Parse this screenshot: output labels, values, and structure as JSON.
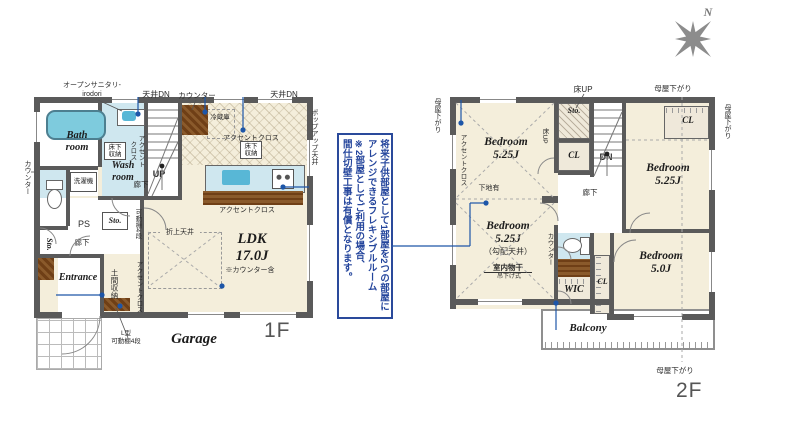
{
  "compass": {
    "label": "N"
  },
  "colors": {
    "wall": "#5a5a5a",
    "floor_cream": "#f4eedb",
    "wet_blue": "#cfe7ef",
    "tub_blue": "#7ecbdd",
    "wood_brown": "#7a4a20",
    "leader_blue": "#1d56a8",
    "note_blue": "#24459c"
  },
  "ann": {
    "lines": [
      "将来子供部屋として1部屋を2つの部屋に",
      "アレンジできるフレキシブルルーム",
      "※2部屋としてご利用の場合、",
      "間仕切壁工事は有償となります。"
    ]
  },
  "f1": {
    "name": "1F",
    "garage": "Garage",
    "rooms": {
      "bath": "Bath\nroom",
      "wash": "Wash\nroom",
      "entrance": "Entrance",
      "ldk": "LDK\n17.0J",
      "ldk_note": "※カウンター含",
      "hall1": "廊下",
      "hall2": "廊下",
      "ps": "PS",
      "sto_hall": "Sto.",
      "sto_left": "Sto.",
      "doma": "土間収納",
      "up": "UP"
    },
    "labels": {
      "open_sanitary": "オープンサニタリ-\nirodori",
      "ceil_dn_l": "天井DN",
      "counter_top": "カウンター",
      "ceil_dn_r": "天井DN",
      "popup": "ポップアップ天井",
      "fridge": "冷蔵庫",
      "accent_kitchen": "アクセントクロス",
      "accent_counter": "アクセントクロス",
      "ufs_kitchen": "床下\n収納",
      "ufs_wash": "床下\n収納",
      "washer": "洗濯機",
      "accent_wash": "アクセント\nクロス",
      "counter_left": "カウンター",
      "shelf4": "可動棚4段",
      "accent_doma": "アクセントクロス",
      "oriage": "折上天井",
      "l_shelf": "L型\n可動棚4段"
    }
  },
  "f2": {
    "name": "2F",
    "rooms": {
      "bed_nw": "Bedroom\n5.25J",
      "bed_ne": "Bedroom\n5.25J",
      "bed_sw": "Bedroom\n5.25J",
      "bed_sw_note": "（勾配天井）",
      "bed_se": "Bedroom\n5.0J",
      "wic": "WIC",
      "balcony": "Balcony",
      "hall": "廊下",
      "sto": "Sto.",
      "cl_c": "CL",
      "cl_ne": "CL",
      "cl_se": "CL",
      "dn": "DN"
    },
    "labels": {
      "moya_nw": "母屋下がり",
      "moya_n": "母屋下がり",
      "moya_e": "母屋下がり",
      "moya_s": "母屋下がり",
      "floor_up": "床UP",
      "floor_up2": "床UP",
      "accent_nw": "アクセントクロス",
      "shitaji": "下地有",
      "laundry": "室内物干",
      "laundry_sub": "吊下げ式",
      "counter": "カウンター"
    }
  }
}
